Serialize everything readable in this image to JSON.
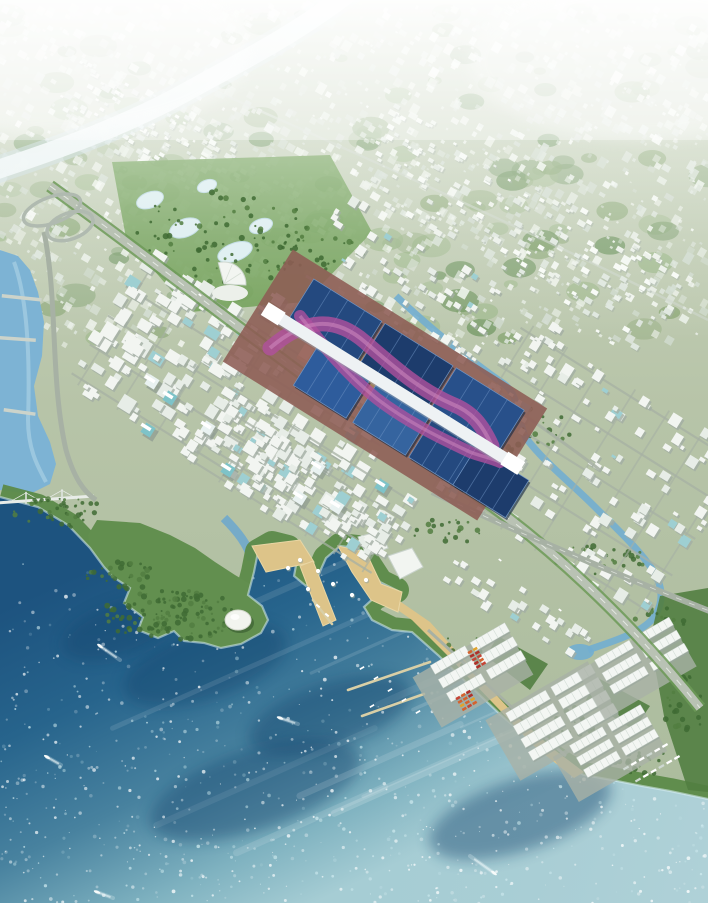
{
  "meta": {
    "title": "Aerial master-plan rendering of a coastal city district",
    "type": "architectural-render",
    "width": 708,
    "height": 903
  },
  "scene": {
    "description": "Bird's-eye rendering: long exhibition center with dark blue roofs and a sweeping magenta ribbon over a white central axis; dense white mid-rise blocks; hazy metropolis and white river to the horizon; deep blue bay with small boats and sun glitter; forested peninsula with white dome; tan waterfront promenade and piers; logistics port with white warehouses, red containers and beach; curving expressway to the lower-right corner.",
    "landmarks": [
      {
        "name": "exhibition-center",
        "label": "Exhibition halls with blue roofs, white axis and magenta ribbon"
      },
      {
        "name": "white-river",
        "label": "Bright river curving from top centre to the left edge"
      },
      {
        "name": "bay",
        "label": "Deep blue sea with sun glitter and boats"
      },
      {
        "name": "green-peninsula",
        "label": "Forested headland with white domed hall"
      },
      {
        "name": "waterfront-promenade",
        "label": "Tan plazas, pavilions and piers"
      },
      {
        "name": "logistics-port",
        "label": "White warehouses, red containers, beach and jetties"
      },
      {
        "name": "expressway",
        "label": "Curving expressway from upper-left to lower-right"
      },
      {
        "name": "cable-bridge",
        "label": "Bridge crossing the west channel"
      }
    ],
    "palette": {
      "land_top": "#cdd7c3",
      "land_mid": "#b7c4a8",
      "land_low": "#a9ba9b",
      "distant_building": [
        "#f8fbf7",
        "#ecf1ea",
        "#dfe7df",
        "#d3ddd3"
      ],
      "distant_green": [
        "#9db88a",
        "#86a470",
        "#6f9560"
      ],
      "river_white": "#eef6f8",
      "river_edge": "#c7dde8",
      "channel_blue": "#7db3d4",
      "channel_light": "#a8d0e4",
      "sea_stops": [
        "#1d537f",
        "#27648c",
        "#48829f",
        "#7fb2c0",
        "#a6cdd4"
      ],
      "sea_dark": "#16476f",
      "foam": "#d8eef2",
      "speckle": "#ffffff",
      "speckle2": "#cde9ee",
      "green_coast": "#5c8a49",
      "green_dark": "#3f6b34",
      "green_mid": "#527e41",
      "green_bright": "#6f9e55",
      "sand": "#ddc489",
      "sand_light": "#e9d6a4",
      "road": "#a7b1a4",
      "road_major": "#b9c2b4",
      "road_verge": "#6d9a58",
      "lane": "#eef1ec",
      "building": "#f2f5f1",
      "building_mid": "#e7ede7",
      "building_shadow": "#a2aea4",
      "glass_teal": "#7ec3c8",
      "roof_blues": [
        "#24497f",
        "#2e5c9c",
        "#1d3c6c",
        "#35649f",
        "#28508a"
      ],
      "roof_streak": "#6f94c4",
      "spine": "#eef2f4",
      "spine_shadow": "#9aa4ad",
      "ribbon": "#b0509d",
      "ribbon_light": "#d08ac0",
      "plaza": "#8d5c54",
      "plaza_light": "#a06a5e",
      "courtyard_tan": "#a5825a",
      "warehouse": "#f3f6f3",
      "warehouse_ridge": "#cdd8d1",
      "lot": "#a9b2a6",
      "container": [
        "#c44536",
        "#d4622e",
        "#b03028",
        "#e0a32e"
      ],
      "dome": "#f2f4ef",
      "bridge": "#ccd3ca",
      "pier_tan": "#d9cfa6",
      "boat": "#f8fbfa",
      "wake": "#eaf6f8"
    },
    "coast": [
      [
        0,
        497
      ],
      [
        38,
        507
      ],
      [
        68,
        525
      ],
      [
        90,
        548
      ],
      [
        104,
        567
      ],
      [
        113,
        577
      ],
      [
        130,
        588
      ],
      [
        124,
        603
      ],
      [
        143,
        617
      ],
      [
        138,
        630
      ],
      [
        158,
        638
      ],
      [
        174,
        631
      ],
      [
        184,
        641
      ],
      [
        204,
        643
      ],
      [
        221,
        648
      ],
      [
        241,
        644
      ],
      [
        261,
        633
      ],
      [
        268,
        620
      ],
      [
        262,
        606
      ],
      [
        248,
        595
      ],
      [
        254,
        572
      ],
      [
        258,
        552
      ],
      [
        272,
        544
      ],
      [
        288,
        548
      ],
      [
        297,
        560
      ],
      [
        294,
        576
      ],
      [
        306,
        586
      ],
      [
        318,
        576
      ],
      [
        326,
        558
      ],
      [
        340,
        546
      ],
      [
        358,
        548
      ],
      [
        367,
        562
      ],
      [
        380,
        582
      ],
      [
        396,
        590
      ],
      [
        376,
        596
      ],
      [
        364,
        607
      ],
      [
        372,
        620
      ],
      [
        392,
        630
      ],
      [
        412,
        632
      ],
      [
        438,
        655
      ],
      [
        468,
        684
      ],
      [
        502,
        716
      ],
      [
        538,
        747
      ],
      [
        566,
        766
      ],
      [
        584,
        775
      ],
      [
        612,
        780
      ],
      [
        642,
        786
      ],
      [
        670,
        791
      ],
      [
        708,
        799
      ]
    ],
    "peninsula": [
      [
        97,
        520
      ],
      [
        140,
        523
      ],
      [
        170,
        535
      ],
      [
        195,
        548
      ],
      [
        215,
        562
      ],
      [
        235,
        575
      ],
      [
        252,
        585
      ],
      [
        262,
        600
      ],
      [
        268,
        620
      ],
      [
        261,
        633
      ],
      [
        241,
        644
      ],
      [
        221,
        648
      ],
      [
        204,
        643
      ],
      [
        184,
        641
      ],
      [
        174,
        631
      ],
      [
        158,
        638
      ],
      [
        138,
        630
      ],
      [
        143,
        617
      ],
      [
        124,
        603
      ],
      [
        130,
        588
      ],
      [
        113,
        577
      ],
      [
        104,
        567
      ],
      [
        90,
        548
      ],
      [
        88,
        535
      ]
    ],
    "left_channel": [
      [
        0,
        250
      ],
      [
        18,
        256
      ],
      [
        30,
        270
      ],
      [
        38,
        292
      ],
      [
        44,
        322
      ],
      [
        42,
        356
      ],
      [
        34,
        386
      ],
      [
        38,
        416
      ],
      [
        50,
        442
      ],
      [
        56,
        464
      ],
      [
        50,
        484
      ],
      [
        30,
        494
      ],
      [
        0,
        490
      ]
    ],
    "park": [
      [
        112,
        162
      ],
      [
        330,
        155
      ],
      [
        372,
        232
      ],
      [
        305,
        302
      ],
      [
        190,
        312
      ],
      [
        126,
        238
      ]
    ],
    "port_greens": [
      [
        [
          660,
          596
        ],
        [
          708,
          588
        ],
        [
          708,
          792
        ],
        [
          688,
          790
        ],
        [
          664,
          716
        ],
        [
          650,
          640
        ]
      ],
      [
        [
          498,
          636
        ],
        [
          548,
          664
        ],
        [
          530,
          690
        ],
        [
          486,
          656
        ]
      ],
      [
        [
          598,
          678
        ],
        [
          650,
          706
        ],
        [
          634,
          730
        ],
        [
          586,
          700
        ]
      ]
    ],
    "beach": [
      [
        398,
        600
      ],
      [
        430,
        622
      ],
      [
        468,
        664
      ],
      [
        512,
        712
      ],
      [
        552,
        748
      ],
      [
        584,
        772
      ],
      [
        574,
        778
      ],
      [
        534,
        746
      ],
      [
        492,
        702
      ],
      [
        448,
        656
      ],
      [
        412,
        620
      ],
      [
        392,
        606
      ]
    ],
    "promenade": [
      [
        [
          252,
          546
        ],
        [
          300,
          540
        ],
        [
          314,
          562
        ],
        [
          266,
          572
        ]
      ],
      [
        [
          300,
          566
        ],
        [
          313,
          561
        ],
        [
          336,
          620
        ],
        [
          323,
          626
        ]
      ],
      [
        [
          338,
          546
        ],
        [
          366,
          552
        ],
        [
          381,
          584
        ],
        [
          402,
          592
        ],
        [
          398,
          612
        ],
        [
          371,
          600
        ],
        [
          352,
          572
        ]
      ]
    ],
    "white_pavilion_buildings": [
      [
        [
          388,
          556
        ],
        [
          412,
          548
        ],
        [
          423,
          567
        ],
        [
          400,
          579
        ]
      ],
      [
        [
          358,
          537
        ],
        [
          380,
          531
        ],
        [
          388,
          548
        ],
        [
          367,
          556
        ]
      ]
    ],
    "paths": {
      "white_river": "M352,-10 C300,32 240,62 186,92 C132,122 70,146 -10,172",
      "ne_river": "M396,296 C432,330 470,360 504,384 C520,396 516,418 526,438 C544,462 570,482 594,506 C618,530 640,550 654,572 C662,586 664,600 656,614 C646,632 616,640 588,650",
      "harbor_channel": "M224,518 C238,532 248,545 252,560",
      "highway": "M50,186 C170,272 312,388 446,474 C548,540 634,626 700,708",
      "secondary_road": "M432,492 C530,538 620,576 712,612",
      "west_road": "M44,232 C58,300 50,380 66,450 C74,478 84,492 96,500",
      "ne_road": "M306,276 C370,312 440,356 520,412 C560,440 585,458 600,470",
      "port_road": "M428,630 C470,668 520,716 566,756",
      "ribbon1": "M270,348 C305,318 335,316 365,342 C395,368 420,390 452,404 C472,412 482,424 492,446",
      "ribbon2": "M300,316 C322,344 344,372 376,398 C404,420 436,436 470,452 C480,456 492,458 500,462",
      "distant_road": "M190,80 C350,150 550,240 708,320"
    },
    "ponds": [
      [
        150,
        200,
        14,
        8
      ],
      [
        185,
        228,
        16,
        9
      ],
      [
        235,
        252,
        18,
        9
      ],
      [
        207,
        186,
        10,
        6
      ],
      [
        261,
        226,
        12,
        7
      ]
    ],
    "bridges": [
      [
        2,
        294,
        40,
        6
      ],
      [
        0,
        336,
        36,
        4
      ],
      [
        4,
        408,
        32,
        8
      ]
    ],
    "cable_bridge": {
      "x1": -4,
      "y1": 503,
      "x2": 94,
      "y2": 496,
      "towers": [
        26,
        62
      ]
    },
    "piers": [
      [
        430,
        662,
        348,
        690
      ],
      [
        424,
        694,
        362,
        716
      ],
      [
        313,
        600,
        332,
        624
      ]
    ],
    "sea_dark_patches": [
      [
        205,
        665,
        85,
        34
      ],
      [
        120,
        630,
        60,
        26
      ],
      [
        330,
        715,
        85,
        32
      ],
      [
        520,
        815,
        95,
        36
      ],
      [
        255,
        790,
        110,
        40
      ]
    ],
    "boats": [
      [
        100,
        646,
        20,
        14
      ],
      [
        280,
        718,
        18,
        6
      ],
      [
        47,
        757,
        14,
        8
      ],
      [
        97,
        892,
        16,
        6
      ],
      [
        494,
        873,
        -24,
        -17
      ]
    ],
    "building_clusters": [
      {
        "cx": 235,
        "cy": 395,
        "w": 300,
        "h": 150,
        "rot": 32,
        "n": 210,
        "min": 5,
        "max": 15,
        "seed": 11,
        "streets": true
      },
      {
        "cx": 300,
        "cy": 480,
        "w": 220,
        "h": 90,
        "rot": 32,
        "n": 90,
        "min": 5,
        "max": 13,
        "seed": 12,
        "streets": true
      },
      {
        "cx": 585,
        "cy": 470,
        "w": 260,
        "h": 190,
        "rot": 32,
        "n": 140,
        "min": 4,
        "max": 11,
        "seed": 13,
        "streets": true
      },
      {
        "cx": 430,
        "cy": 300,
        "w": 260,
        "h": 90,
        "rot": 32,
        "n": 70,
        "min": 4,
        "max": 9,
        "seed": 14,
        "streets": false
      },
      {
        "cx": 330,
        "cy": 498,
        "w": 180,
        "h": 56,
        "rot": 32,
        "n": 46,
        "min": 5,
        "max": 11,
        "seed": 15,
        "streets": false
      },
      {
        "cx": 520,
        "cy": 608,
        "w": 160,
        "h": 34,
        "rot": 32,
        "n": 26,
        "min": 5,
        "max": 9,
        "seed": 16,
        "streets": false
      }
    ],
    "distant_bands": [
      {
        "cx": 180,
        "cy": 150,
        "w": 260,
        "h": 70,
        "rot": 30,
        "n": 130,
        "min": 3,
        "max": 7,
        "seed": 21
      },
      {
        "cx": 520,
        "cy": 230,
        "w": 340,
        "h": 100,
        "rot": 30,
        "n": 170,
        "min": 3,
        "max": 8,
        "seed": 22
      }
    ],
    "towers": [
      [
        152,
        382
      ],
      [
        170,
        398
      ],
      [
        208,
        428
      ],
      [
        148,
        430
      ],
      [
        318,
        468
      ],
      [
        352,
        434
      ],
      [
        300,
        498
      ],
      [
        382,
        486
      ],
      [
        337,
        507
      ],
      [
        228,
        470
      ],
      [
        278,
        300
      ],
      [
        265,
        312
      ]
    ],
    "tree_patches": [
      [
        170,
        615,
        70,
        26,
        120
      ],
      [
        60,
        512,
        46,
        16,
        40
      ],
      [
        122,
        576,
        38,
        14,
        30
      ],
      [
        222,
        236,
        88,
        52,
        90
      ],
      [
        470,
        650,
        32,
        16,
        26
      ],
      [
        560,
        720,
        42,
        18,
        30
      ],
      [
        640,
        762,
        32,
        13,
        22
      ],
      [
        684,
        706,
        20,
        34,
        28
      ],
      [
        520,
        430,
        55,
        22,
        34
      ],
      [
        600,
        560,
        46,
        18,
        28
      ],
      [
        310,
        250,
        60,
        20,
        26
      ],
      [
        450,
        530,
        40,
        14,
        20
      ],
      [
        660,
        620,
        26,
        12,
        16
      ]
    ],
    "exhibition": {
      "x1": 280,
      "y1": 318,
      "x2": 506,
      "y2": 459,
      "spine_w": 12,
      "ne_row": {
        "t": [
          48,
          132,
          216
        ],
        "off": -28,
        "w": 80,
        "h": 46
      },
      "sw_row": {
        "t": [
          78,
          148,
          214,
          266
        ],
        "off": 28,
        "w": 62,
        "h": 44
      },
      "plaza": {
        "cx": 385,
        "cy": 385,
        "w": 300,
        "h": 132,
        "rot": 32
      },
      "courtyard": {
        "cx": 356,
        "cy": 365,
        "w": 70,
        "h": 26
      }
    },
    "fan_building": {
      "x": 224,
      "y": 284,
      "r": 22
    },
    "dome": {
      "x": 238,
      "y": 620,
      "rx": 13,
      "ry": 10
    },
    "pavilions": [
      [
        300,
        560
      ],
      [
        318,
        571
      ],
      [
        333,
        584
      ],
      [
        352,
        595
      ],
      [
        366,
        580
      ],
      [
        308,
        589
      ],
      [
        288,
        568
      ]
    ],
    "warehouse_clusters": [
      {
        "x": 450,
        "y": 660,
        "rows": 3,
        "cols": 2,
        "w": 40,
        "h": 10,
        "ga": 46,
        "gp": 16
      },
      {
        "x": 528,
        "y": 706,
        "rows": 4,
        "cols": 2,
        "w": 46,
        "h": 10,
        "ga": 52,
        "gp": 15
      },
      {
        "x": 588,
        "y": 740,
        "rows": 3,
        "cols": 2,
        "w": 38,
        "h": 9,
        "ga": 44,
        "gp": 14
      },
      {
        "x": 614,
        "y": 654,
        "rows": 3,
        "cols": 2,
        "w": 40,
        "h": 9,
        "ga": 46,
        "gp": 15
      }
    ],
    "container_groups": [
      {
        "x": 470,
        "y": 652,
        "rows": 5,
        "cols": 2
      },
      {
        "x": 458,
        "y": 698,
        "rows": 4,
        "cols": 3
      }
    ],
    "truck_rows": [
      {
        "x": 626,
        "y": 768,
        "n": 6
      },
      {
        "x": 638,
        "y": 780,
        "n": 6
      }
    ],
    "marina_boats": [
      [
        362,
        668
      ],
      [
        376,
        678
      ],
      [
        390,
        690
      ],
      [
        404,
        700
      ],
      [
        372,
        706
      ],
      [
        418,
        712
      ]
    ],
    "ferry_boats": [
      [
        318,
        606
      ],
      [
        327,
        615
      ]
    ],
    "interchange": [
      [
        52,
        210
      ],
      [
        70,
        226
      ]
    ],
    "vehicles": [
      [
        200,
        295
      ],
      [
        260,
        345
      ],
      [
        330,
        402
      ],
      [
        500,
        560
      ],
      [
        560,
        610
      ]
    ],
    "counts": {
      "distant_specks": 1500,
      "distant_greens": 140,
      "sea_speckles": 1000,
      "sea_streaks": 14
    }
  }
}
